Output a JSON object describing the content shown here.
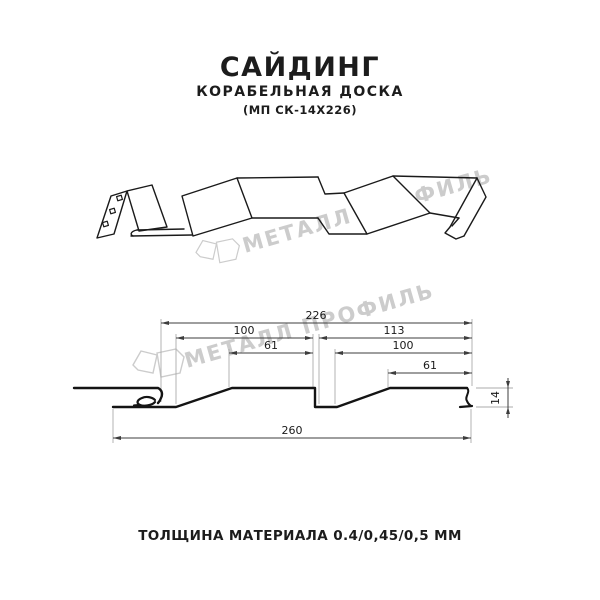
{
  "header": {
    "title": "САЙДИНГ",
    "subtitle": "КОРАБЕЛЬНАЯ ДОСКА",
    "code": "(МП СК-14Х226)"
  },
  "watermark": {
    "brand": "МЕТАЛЛ ПРОФИЛЬ",
    "color": "#cccccc"
  },
  "section": {
    "dim_226": "226",
    "dim_100_left": "100",
    "dim_61_left": "61",
    "dim_113": "113",
    "dim_100_right": "100",
    "dim_61_right": "61",
    "dim_260": "260",
    "dim_14": "14"
  },
  "footer": {
    "text": "ТОЛЩИНА МАТЕРИАЛА 0.4/0,45/0,5 ММ"
  }
}
